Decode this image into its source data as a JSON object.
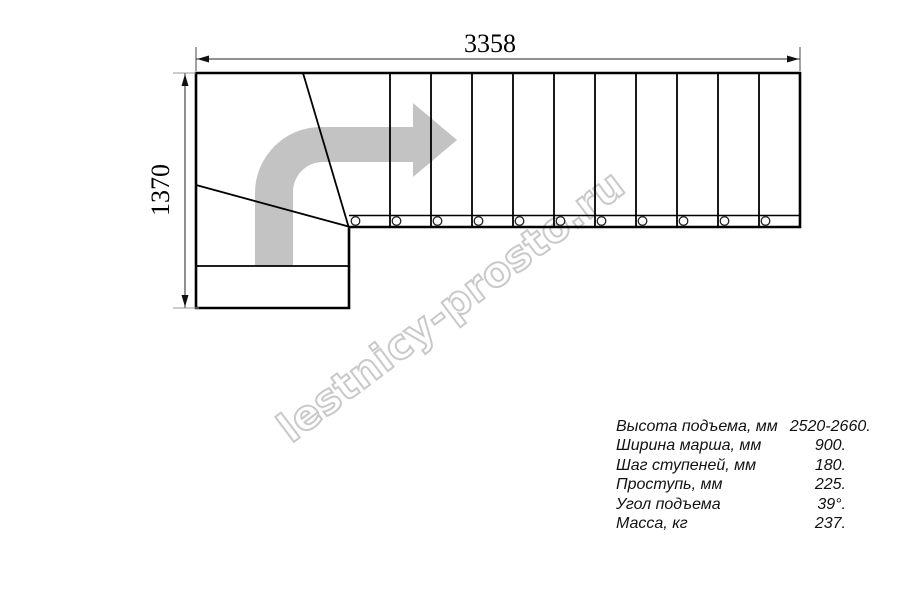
{
  "diagram": {
    "watermark_text": "lestnicy-prosto.ru",
    "dim_width_mm": "3358",
    "dim_height_mm": "1370",
    "flight": {
      "step_lines": 10,
      "baluster_circles": 11
    },
    "winder_steps": 3,
    "entry_steps": 2,
    "colors": {
      "line": "#000000",
      "dimension": "#222222",
      "extension": "#999999",
      "arrow_fill": "#c3c3c3",
      "watermark_stroke": "#c9c9c9"
    }
  },
  "specs": {
    "rows": [
      {
        "label": "Высота подъема, мм",
        "value": "2520-2660."
      },
      {
        "label": "Ширина марша, мм",
        "value": "900."
      },
      {
        "label": "Шаг ступеней, мм",
        "value": "180."
      },
      {
        "label": "Проступь, мм",
        "value": "225."
      },
      {
        "label": "Угол подъема",
        "value": "39°."
      },
      {
        "label": "Масса, кг",
        "value": "237."
      }
    ]
  }
}
